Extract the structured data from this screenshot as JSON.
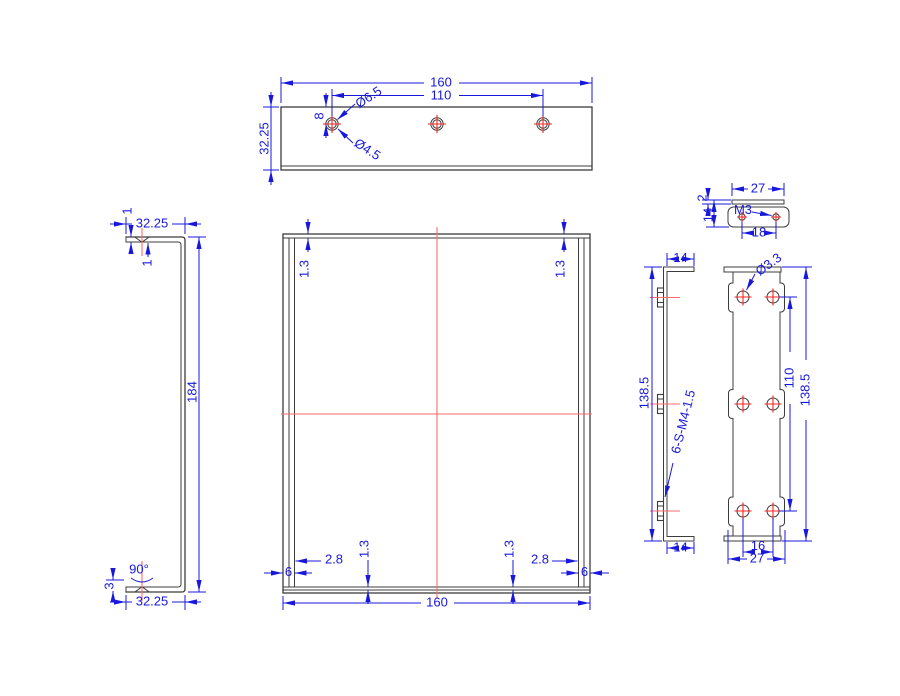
{
  "drawing_type": "engineering-drawing",
  "colors": {
    "outline": "#3c3c3c",
    "dimension": "#1818dd",
    "centerline": "#ff6b6b",
    "hole_cross": "#ff2222",
    "background": "#ffffff"
  },
  "views": {
    "plate_top": {
      "width": "160",
      "hole_spacing": "110",
      "depth": "32.25",
      "hole_offset": "8",
      "countersink": "Ø6.5",
      "hole": "Ø4.5"
    },
    "channel_side": {
      "flange_top": "32.25",
      "t1": "1",
      "t2": "1",
      "height": "184",
      "angle": "90°",
      "flange_bottom": "32.25",
      "lip": "3"
    },
    "plate_front": {
      "lip_tl": "1.3",
      "lip_tr": "1.3",
      "edge_l": "6",
      "edge_r": "6",
      "offset_l": "2.8",
      "offset_r": "2.8",
      "lip_bl": "1.3",
      "lip_br": "1.3",
      "width": "160"
    },
    "clamp_top": {
      "width": "27",
      "hole_spacing": "18",
      "thread": "M3",
      "thickness": "2",
      "height": "14"
    },
    "rail_side": {
      "flange_top": "14",
      "height": "138.5",
      "note": "6-S-M4-1.5",
      "flange_bottom": "14"
    },
    "rail_front": {
      "hole": "Ø3.3",
      "span": "110",
      "height": "138.5",
      "pitch": "16",
      "width": "27"
    }
  }
}
